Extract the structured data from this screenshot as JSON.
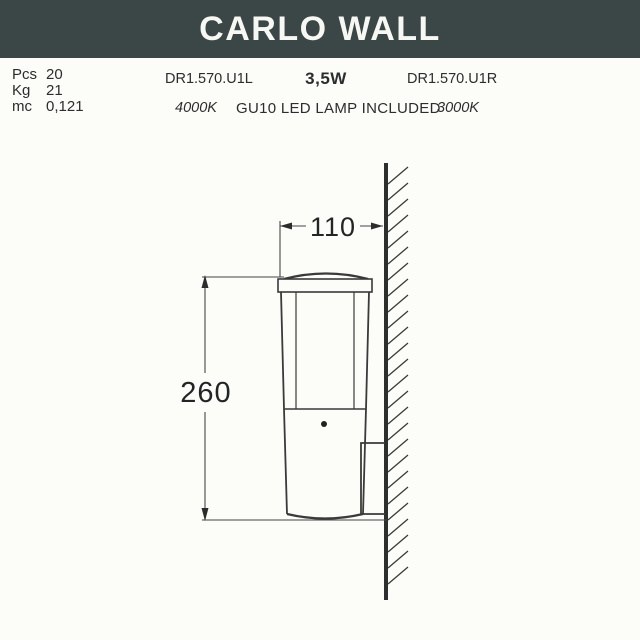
{
  "header": {
    "title": "CARLO WALL"
  },
  "specs": {
    "packaging": [
      {
        "label": "Pcs",
        "value": "20"
      },
      {
        "label": "Kg",
        "value": "21"
      },
      {
        "label": "mc",
        "value": "0,121"
      }
    ],
    "model_code_left": "DR1.570.U1L",
    "wattage": "3,5W",
    "model_code_right": "DR1.570.U1R",
    "color_temp_left": "4000K",
    "lamp_note": "GU10 LED LAMP INCLUDED",
    "color_temp_right": "3000K"
  },
  "drawing": {
    "width_mm": "110",
    "height_mm": "260"
  },
  "colors": {
    "header_bg": "#3b4646",
    "header_text": "#f7f8f4",
    "page_bg": "#fcfcf8",
    "line_color": "#3a3a3a"
  }
}
